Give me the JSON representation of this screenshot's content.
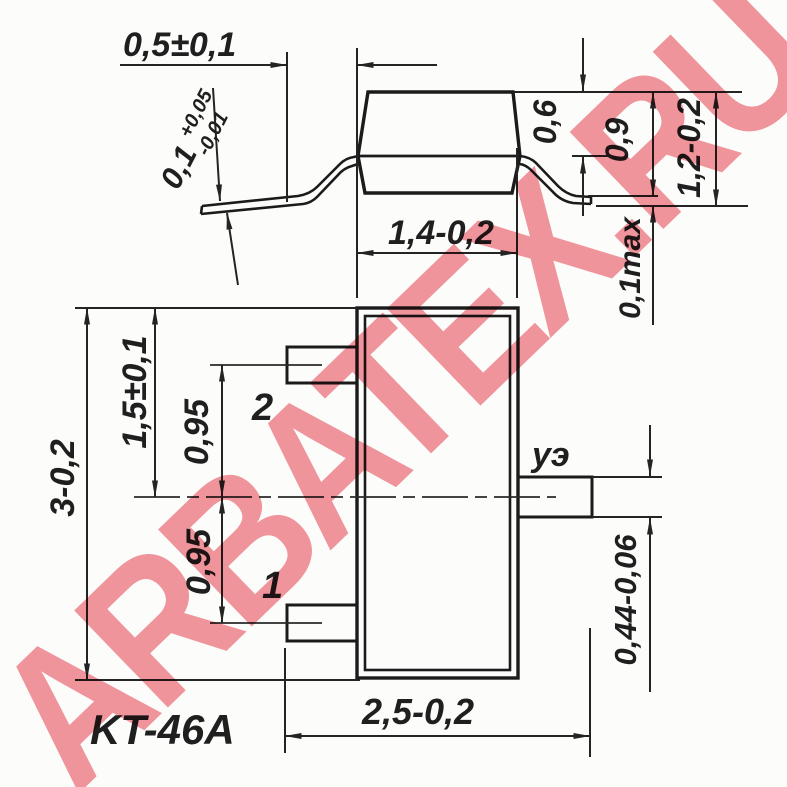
{
  "watermark": {
    "text": "ARBATEX.RU",
    "color": "#f2969e"
  },
  "drawing": {
    "package_name": "KT-46A",
    "side_view": {
      "lead_foot_length": "0,5±0,1",
      "lead_thickness_nominal": "0,1",
      "lead_thickness_tol_plus": "+0,05",
      "lead_thickness_tol_minus": "-0,01",
      "body_width": "1,4-0,2",
      "top_to_seam": "0,6",
      "body_thickness": "0,9",
      "total_height": "1,2-0,2",
      "standoff": "0,1max"
    },
    "top_view": {
      "body_length": "3-0,2",
      "half_length": "1,5±0,1",
      "lead_pitch_upper": "0,95",
      "lead_pitch_lower": "0,95",
      "overall_width": "2,5-0,2",
      "lead3_width": "0,44-0,06",
      "pin1_label": "1",
      "pin2_label": "2",
      "pin3_label": "уэ"
    }
  }
}
